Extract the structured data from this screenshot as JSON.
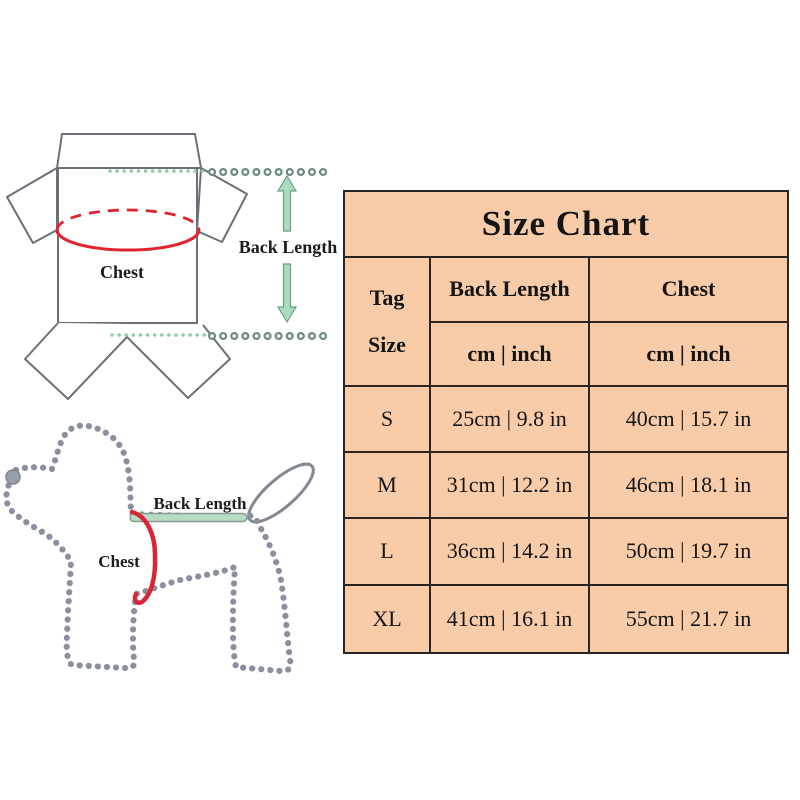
{
  "colors": {
    "table_bg": "#F8CCA8",
    "table_border": "#2A2522",
    "text": "#141414",
    "red_marker": "#E0242E",
    "green_arrow_fill": "#A9DCBF",
    "green_dots": "#8FCCA4",
    "bead_line": "#6E8A85",
    "dog_outline": "#8B90A0",
    "garment_outline": "#6B7078"
  },
  "garment_diagram": {
    "chest_label": "Chest",
    "back_length_label": "Back Length"
  },
  "dog_diagram": {
    "chest_label": "Chest",
    "back_length_label": "Back Length"
  },
  "size_chart": {
    "title": "Size Chart",
    "header": {
      "tag_line1": "Tag",
      "tag_line2": "Size",
      "back_length": "Back Length",
      "chest": "Chest",
      "back_length_units": "cm | inch",
      "chest_units": "cm | inch"
    },
    "rows": [
      {
        "size": "S",
        "back_length": "25cm | 9.8 in",
        "chest": "40cm | 15.7 in"
      },
      {
        "size": "M",
        "back_length": "31cm | 12.2 in",
        "chest": "46cm | 18.1 in"
      },
      {
        "size": "L",
        "back_length": "36cm | 14.2 in",
        "chest": "50cm | 19.7 in"
      },
      {
        "size": "XL",
        "back_length": "41cm | 16.1 in",
        "chest": "55cm | 21.7 in"
      }
    ]
  },
  "chart_data": {
    "type": "table",
    "title": "Size Chart",
    "columns": [
      "Tag Size",
      "Back Length (cm)",
      "Back Length (inch)",
      "Chest (cm)",
      "Chest (inch)"
    ],
    "rows": [
      [
        "S",
        25,
        9.8,
        40,
        15.7
      ],
      [
        "M",
        31,
        12.2,
        46,
        18.1
      ],
      [
        "L",
        36,
        14.2,
        50,
        19.7
      ],
      [
        "XL",
        41,
        16.1,
        55,
        21.7
      ]
    ]
  }
}
